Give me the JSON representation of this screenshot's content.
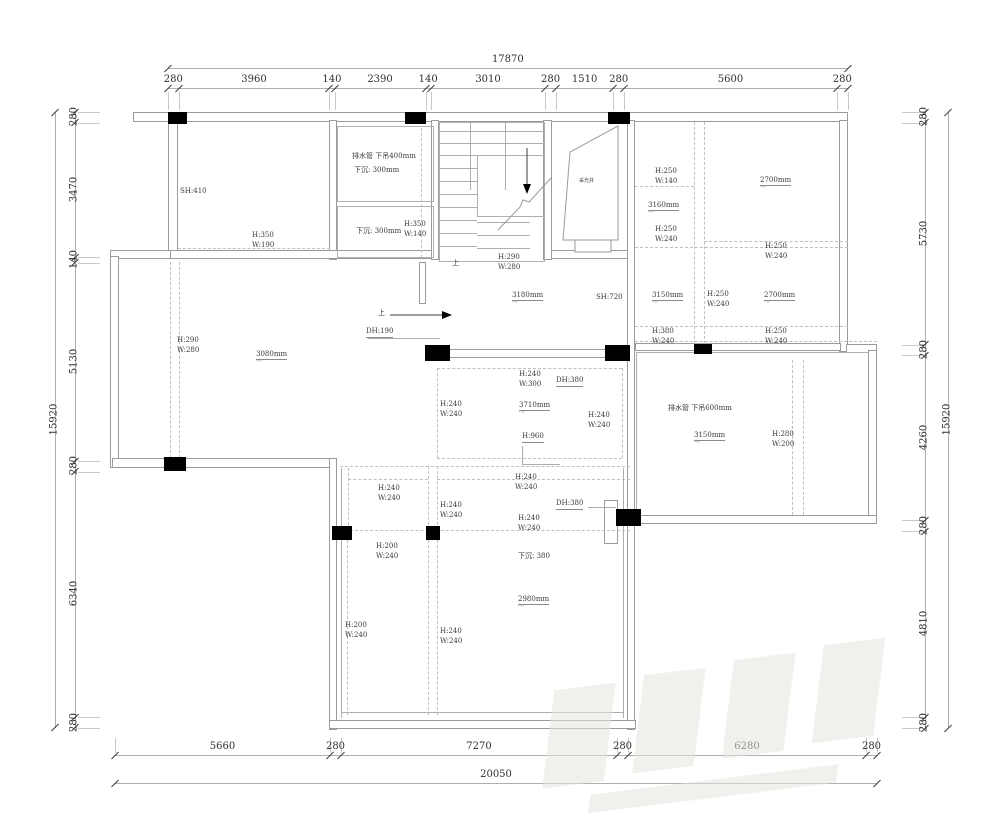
{
  "dims": {
    "top": {
      "total": "17870",
      "segments": [
        "280",
        "3960",
        "140",
        "2390",
        "140",
        "3010",
        "280",
        "1510",
        "280",
        "5600",
        "280"
      ]
    },
    "bottom": {
      "total": "20050",
      "segments": [
        "5660",
        "280",
        "7270",
        "280",
        "6280",
        "280"
      ]
    },
    "left": {
      "total": "15920",
      "segments": [
        "280",
        "3470",
        "140",
        "5130",
        "280",
        "6340",
        "280"
      ]
    },
    "right": {
      "total": "15920",
      "segments": [
        "280",
        "5730",
        "280",
        "4260",
        "280",
        "4810",
        "280"
      ]
    }
  },
  "labels": {
    "sh410": "SH:410",
    "tl_win": "H:350\nW:190",
    "box1_l1": "排水管 下吊400mm",
    "box1_l2": "下沉: 300mm",
    "box2_l1": "下沉: 300mm",
    "box2_win": "H:350\nW:140",
    "stair_up": "上",
    "c_win_top": "H:290\nW:280",
    "lightwell": "采光井",
    "r_win1": "H:250\nW:140",
    "r_lvl1": "2700mm",
    "r_lvl2": "3160mm",
    "r_win2": "H:250\nW:240",
    "r_win3": "H:250\nW:240",
    "c_lvl": "3180mm",
    "sh720": "SH:720",
    "up2": "上",
    "dh190": "DH:190",
    "r_lvl3": "3150mm",
    "r_win4": "H:250\nW:240",
    "r_lvl4": "2700mm",
    "r_win5": "H:380\nW:240",
    "r_win6": "H:250\nW:240",
    "ml_win": "H:290\nW:280",
    "ml_lvl": "3080mm",
    "m_win1": "H:240\nW:300",
    "m_dh": "DH:380",
    "m_win2": "H:240\nW:240",
    "m_lvl": "3710mm",
    "m_win3": "H:240\nW:240",
    "m_h960": "H:960",
    "rl_pipe": "排水管 下吊600mm",
    "rl_lvl": "3150mm",
    "rl_win": "H:280\nW:200",
    "lb_win1": "H:240\nW:240",
    "lb_win2": "H:240\nW:240",
    "lb_win3": "H:240\nW:240",
    "lb_dh": "DH:380",
    "lb_win4": "H:240\nW:240",
    "lb_win5": "H:200\nW:240",
    "sink380": "下沉: 380",
    "b_lvl": "2980mm",
    "b_win1": "H:200\nW:240",
    "b_win2": "H:240\nW:240"
  },
  "colors": {
    "wall": "#9b9b9b",
    "column": "#000000",
    "dashed": "#c0c0c0",
    "text": "#3a3a3a",
    "dim_text": "#2f2f2f",
    "watermark": "#e6e4e0"
  }
}
